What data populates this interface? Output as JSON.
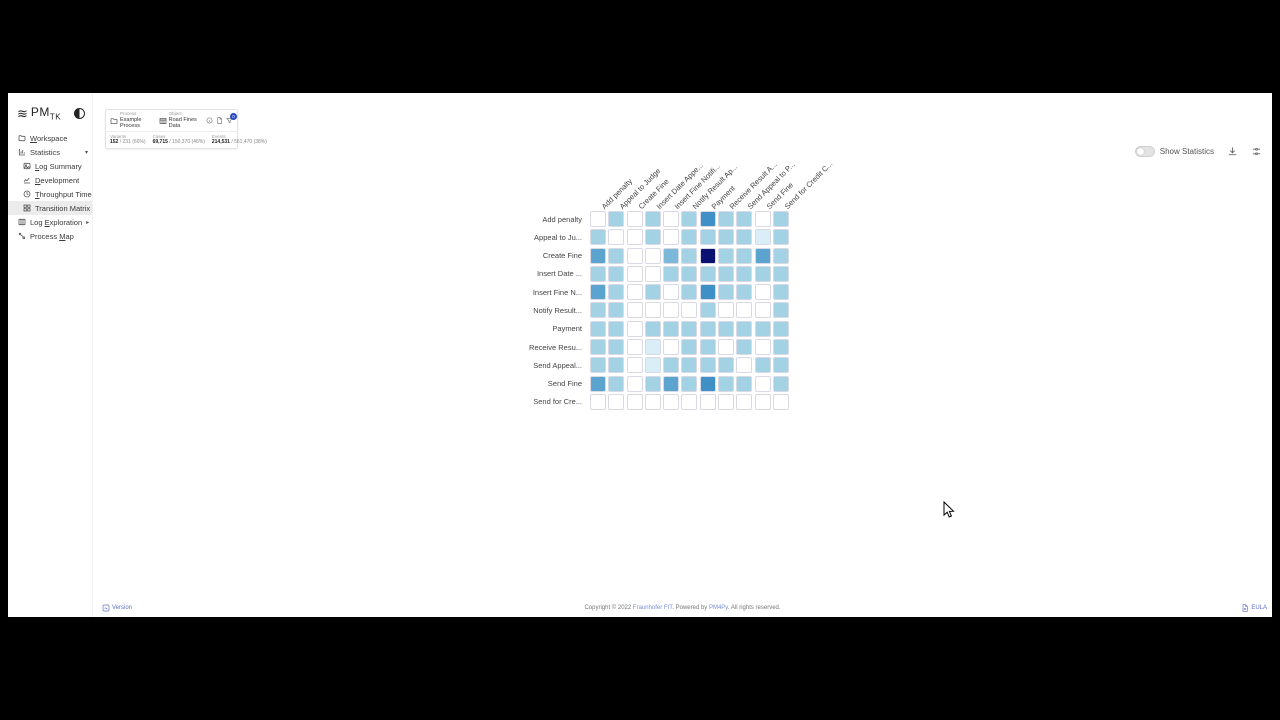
{
  "sidebar": {
    "logo": {
      "glyph": "≋",
      "brand": "PM",
      "brand_sub": "TK"
    },
    "items": [
      {
        "label": "Workspace",
        "accesskey": "W",
        "icon": "folder-icon",
        "indent": 0,
        "caret": "",
        "selected": false
      },
      {
        "label": "Statistics",
        "accesskey": "",
        "icon": "bar-chart-icon",
        "indent": 0,
        "caret": "down",
        "selected": false
      },
      {
        "label": "Log Summary",
        "accesskey": "L",
        "icon": "image-icon",
        "indent": 1,
        "caret": "",
        "selected": false
      },
      {
        "label": "Development",
        "accesskey": "D",
        "icon": "line-chart-icon",
        "indent": 1,
        "caret": "",
        "selected": false
      },
      {
        "label": "Throughput Time",
        "accesskey": "T",
        "icon": "clock-icon",
        "indent": 1,
        "caret": "",
        "selected": false
      },
      {
        "label": "Transition Matrix",
        "accesskey": "",
        "icon": "grid-icon",
        "indent": 1,
        "caret": "",
        "selected": true
      },
      {
        "label": "Log Exploration",
        "accesskey": "E",
        "icon": "columns-icon",
        "indent": 0,
        "caret": "right",
        "selected": false
      },
      {
        "label": "Process Map",
        "accesskey": "M",
        "icon": "route-icon",
        "indent": 0,
        "caret": "",
        "selected": false
      }
    ]
  },
  "topbar": {
    "process": {
      "kind": "Process",
      "name": "Example Process"
    },
    "object": {
      "kind": "Object",
      "name": "Road Fines Data"
    },
    "filter_badge": "0",
    "stats": [
      {
        "label": "Variants",
        "current": "152",
        "rest": " / 231 (66%)"
      },
      {
        "label": "Cases",
        "current": "69,715",
        "rest": " / 150,370 (46%)"
      },
      {
        "label": "Events",
        "current": "214,531",
        "rest": " / 561,470 (38%)"
      }
    ]
  },
  "controls": {
    "show_statistics": "Show Statistics",
    "toggle_on": false
  },
  "chart_data": {
    "type": "heatmap",
    "title": "Transition Matrix",
    "columns": [
      "Add penalty",
      "Appeal to Judge",
      "Create Fine",
      "Insert Date Appe...",
      "Insert Fine Notifi...",
      "Notify Result Ap...",
      "Payment",
      "Receive Result A...",
      "Send Appeal to P...",
      "Send Fine",
      "Send for Credit C..."
    ],
    "rows": [
      "Add penalty",
      "Appeal to Ju...",
      "Create Fine",
      "Insert Date ...",
      "Insert Fine N...",
      "Notify Result...",
      "Payment",
      "Receive Resu...",
      "Send Appeal...",
      "Send Fine",
      "Send for Cre..."
    ],
    "values": [
      [
        0,
        2,
        0,
        2,
        0,
        2,
        5,
        2,
        2,
        0,
        2
      ],
      [
        2,
        0,
        0,
        2,
        0,
        2,
        2,
        2,
        2,
        1,
        2
      ],
      [
        4,
        2,
        0,
        0,
        3,
        2,
        6,
        2,
        2,
        4,
        2
      ],
      [
        2,
        2,
        0,
        0,
        2,
        2,
        2,
        2,
        2,
        2,
        2
      ],
      [
        4,
        2,
        0,
        2,
        0,
        2,
        5,
        2,
        2,
        0,
        2
      ],
      [
        2,
        2,
        0,
        0,
        0,
        0,
        2,
        0,
        0,
        0,
        2
      ],
      [
        2,
        2,
        0,
        2,
        2,
        2,
        2,
        2,
        2,
        2,
        2
      ],
      [
        2,
        2,
        0,
        1,
        0,
        2,
        2,
        0,
        2,
        0,
        2
      ],
      [
        2,
        2,
        0,
        1,
        2,
        2,
        2,
        2,
        0,
        2,
        2
      ],
      [
        4,
        2,
        0,
        2,
        4,
        2,
        5,
        2,
        2,
        0,
        2
      ],
      [
        0,
        0,
        0,
        0,
        0,
        0,
        0,
        0,
        0,
        0,
        0
      ]
    ],
    "palette": [
      "#ffffff",
      "#d9eef7",
      "#a3d2e4",
      "#7cb8da",
      "#5ba4d0",
      "#3f90c6",
      "#0a1172"
    ],
    "value_scale": "0=no transitions … 6=maximum transition frequency",
    "legend_position": "none"
  },
  "footer": {
    "version": "Version",
    "eula": "EULA",
    "copyright_prefix": "Copyright © 2022 ",
    "copyright_link1": "Fraunhofer FIT",
    "copyright_mid": ". Powered by ",
    "copyright_link2": "PM4Py",
    "copyright_suffix": ". All rights reserved."
  },
  "colors": {
    "accent_badge": "#2747c9",
    "link": "#5b6ec9",
    "selected_nav_bg": "#ececec"
  }
}
